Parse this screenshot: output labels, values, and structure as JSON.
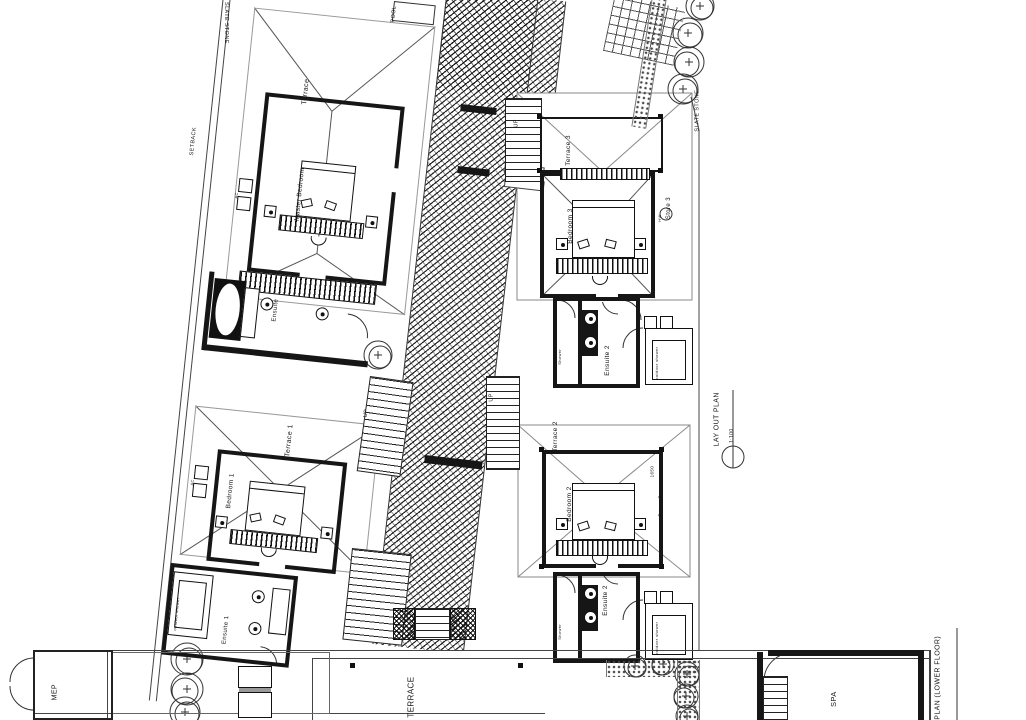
{
  "colors": {
    "ink": "#161616",
    "gray": "#8a8a8a"
  },
  "site": {
    "slate_stone_left": "SLATE STONE",
    "slate_stone_right": "SLATE STONE",
    "setback": "SETBACK",
    "pool_box": "POOL",
    "up": "UP"
  },
  "master_villa": {
    "terrace": "Terrace",
    "bedroom": "Master Bedroom",
    "ensuite": "Ensuite",
    "ac": "AC"
  },
  "villa1": {
    "terrace": "Terrace 1",
    "bedroom": "Bedroom 1",
    "ensuite": "Ensuite 1",
    "outdoor_shower": "outdoor shower",
    "ac": "AC"
  },
  "villa3": {
    "terrace": "Terrace 3",
    "bedroom": "Bedroom 3",
    "store": "Store 3",
    "hw": "HW"
  },
  "ensuite2_upper": {
    "label": "Ensuite 2",
    "shower": "Shower",
    "outdoor_shower": "outdoor shower"
  },
  "villa2": {
    "terrace": "Terrace 2",
    "bedroom": "Bedroom 2",
    "store": "Store 2",
    "dim": "1650"
  },
  "ensuite2_lower": {
    "label": "Ensuite 2",
    "shower": "Shower",
    "outdoor_shower": "outdoor shower"
  },
  "common": {
    "terrace": "TERRACE",
    "spa": "SPA",
    "mep": "MEP"
  },
  "titles": {
    "layout_plan": "LAY OUT PLAN",
    "layout_scale": "1:100",
    "spa_plan": "SPA PLAN (LOWER FLOOR)",
    "spa_scale": "1:100"
  }
}
